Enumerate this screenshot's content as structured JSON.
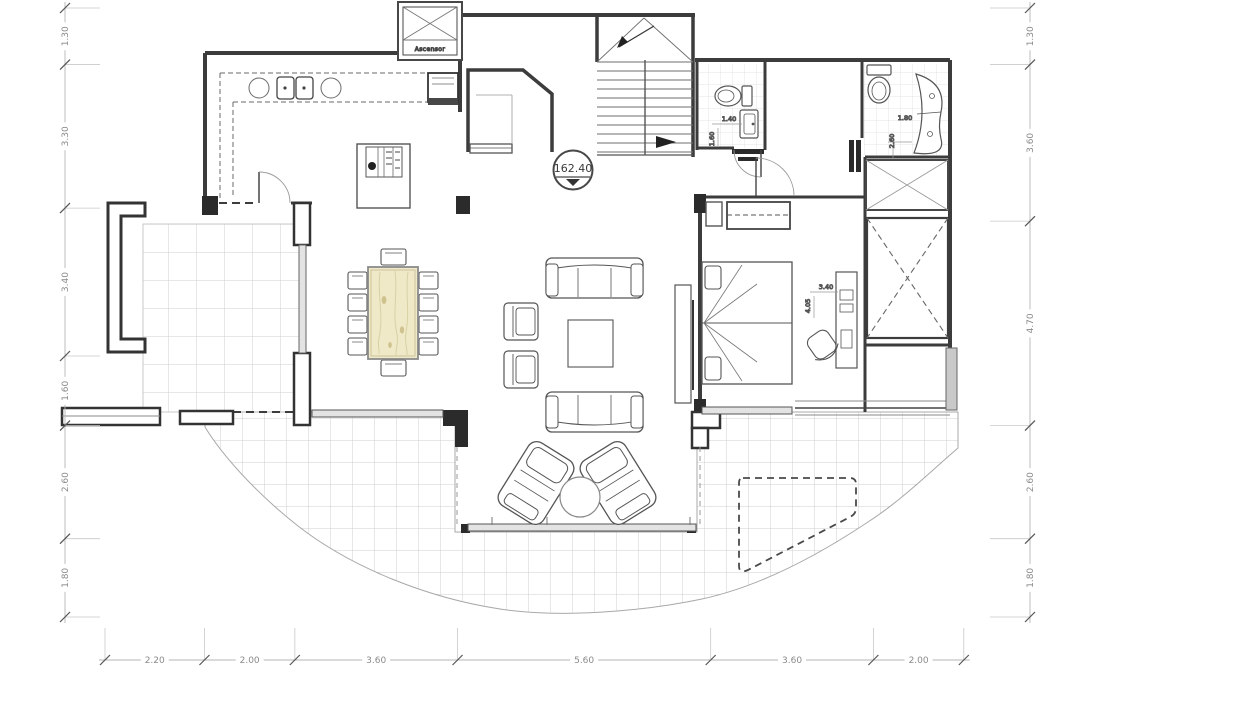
{
  "labels": {
    "elevator": "Ascensor",
    "level_mark": "162.40"
  },
  "rulers": {
    "left": {
      "labels": [
        "1.30",
        "3.30",
        "3.40",
        "1.60",
        "2.60",
        "1.80"
      ]
    },
    "right": {
      "labels": [
        "1.30",
        "3.60",
        "4.70",
        "2.60",
        "1.80"
      ]
    },
    "bottom": {
      "labels": [
        "2.20",
        "2.00",
        "3.60",
        "5.60",
        "3.60",
        "2.00"
      ]
    }
  },
  "room_dimensions": {
    "bath1_width": "1.40",
    "bath1_depth": "1.60",
    "bath2_width": "1.80",
    "bath2_depth": "2.60",
    "bedroom_width": "3.40",
    "bedroom_depth": "4.05"
  },
  "colors": {
    "wall": "#3c3c3c",
    "furniture_line": "#5a5a5a",
    "grid_line": "#cfcfcf",
    "wood_fill": "#efe9c8",
    "wood_grain": "#d9d1a4",
    "glass_fill": "#e3e3e3",
    "dim_text": "#8a8a8a",
    "background": "#ffffff"
  }
}
